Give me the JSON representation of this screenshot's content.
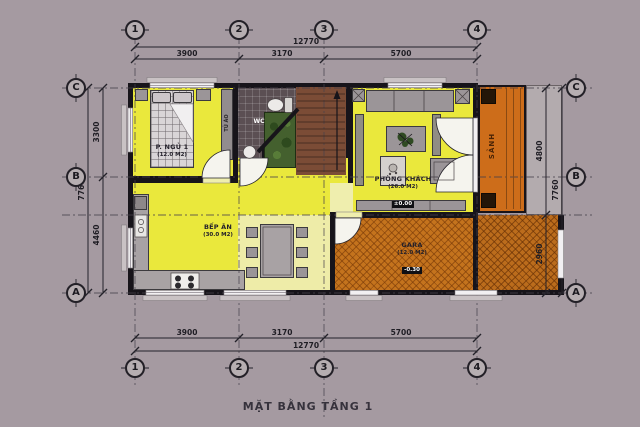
{
  "title": "MẶT BẰNG TẦNG 1",
  "grid": {
    "cols": [
      "1",
      "2",
      "3",
      "4"
    ],
    "rows": [
      "C",
      "B",
      "A"
    ]
  },
  "dims": {
    "horizontal": {
      "overall": "12770",
      "segments": [
        "3900",
        "3170",
        "5700"
      ]
    },
    "left": {
      "overall": "7760",
      "segments": [
        "3300",
        "4460"
      ]
    },
    "right": {
      "overall": "7760",
      "segments": [
        "4800",
        "2960"
      ]
    }
  },
  "rooms": {
    "bedroom": {
      "name": "P. NGỦ 1",
      "area": "(12.0 M2)"
    },
    "kitchen": {
      "name": "BẾP ĂN",
      "area": "(30.0 M2)"
    },
    "living": {
      "name": "PHÒNG KHÁCH",
      "area": "(26.0 M2)",
      "level": "±0.00"
    },
    "garage": {
      "name": "GARA",
      "area": "(12.0 M2)",
      "level": "-0.30"
    },
    "wc": {
      "name": "WC"
    },
    "porch": {
      "name": "SẢNH"
    },
    "wardrobe": {
      "name": "TỦ ÁO"
    }
  },
  "colors": {
    "background": "#a59aa1",
    "wall": "#17141a",
    "room_fill": "#eae83c",
    "circulation_fill": "#efeeae",
    "garage_fill": "#c4731d",
    "porch_fill": "#cd6d1a",
    "bathroom_tile": "#5b4f53",
    "stair": "#7b4c36",
    "planter": "#44602e",
    "furniture": "#9b9598"
  }
}
